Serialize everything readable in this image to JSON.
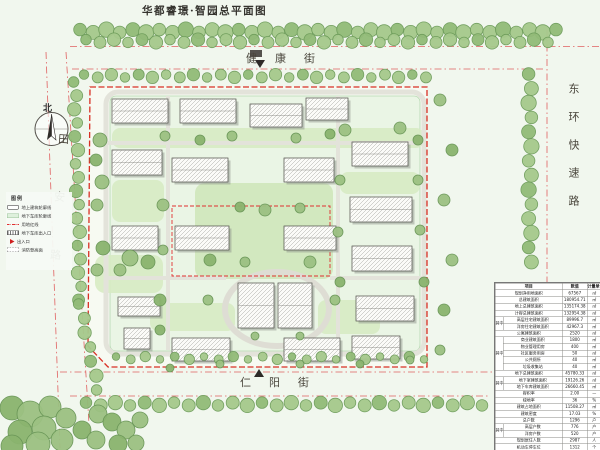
{
  "title": "华都睿璟·智园总平面图",
  "north": {
    "label": "北"
  },
  "streets": {
    "top": "健康街",
    "bottom": "仁阳街",
    "left": "田安路",
    "right": "东环快速路"
  },
  "legend": {
    "title": "图例",
    "items": [
      {
        "name": "building-outline",
        "swatch": "sw-building",
        "label": "地上建筑轮廓线"
      },
      {
        "name": "garage-outline",
        "swatch": "sw-garage",
        "label": "地下车库轮廓线"
      },
      {
        "name": "red-property-line",
        "swatch": "sw-redline",
        "label": "用地红线"
      },
      {
        "name": "garage-entrance",
        "swatch": "sw-gentry",
        "label": "地下车库出入口"
      },
      {
        "name": "site-entrance",
        "swatch": "sw-entry",
        "label": "出入口"
      },
      {
        "name": "fire-lane",
        "swatch": "sw-fire",
        "label": "消防登高面"
      }
    ]
  },
  "table": {
    "headers": [
      "项目",
      "数值",
      "计量单位"
    ],
    "group_label": "其中",
    "rows": [
      {
        "item": "规划净用地面积",
        "value": "67567",
        "unit": "㎡"
      },
      {
        "item": "总建筑面积",
        "value": "180954.71",
        "unit": "㎡"
      },
      {
        "item": "地上总建筑面积",
        "value": "135174.38",
        "unit": "㎡"
      },
      {
        "item": "计容总建筑面积",
        "value": "132954.38",
        "unit": "㎡"
      },
      {
        "g": 1,
        "item": "高层住宅建筑面积",
        "value": "89996.7",
        "unit": "㎡"
      },
      {
        "g": 1,
        "item": "洋房住宅建筑面积",
        "value": "42967.3",
        "unit": "㎡"
      },
      {
        "item": "公寓建筑面积",
        "value": "2520",
        "unit": "㎡"
      },
      {
        "g": 2,
        "item": "商业建筑面积",
        "value": "1800",
        "unit": "㎡"
      },
      {
        "g": 2,
        "item": "物业管理用房",
        "value": "400",
        "unit": "㎡"
      },
      {
        "g": 2,
        "item": "社区服务用房",
        "value": "50",
        "unit": "㎡"
      },
      {
        "g": 2,
        "item": "公共厕所",
        "value": "40",
        "unit": "㎡"
      },
      {
        "g": 2,
        "item": "垃圾收集站",
        "value": "40",
        "unit": "㎡"
      },
      {
        "item": "地下总建筑面积",
        "value": "45780.33",
        "unit": "㎡"
      },
      {
        "g": 3,
        "item": "地下室建筑面积",
        "value": "19126.26",
        "unit": "㎡"
      },
      {
        "g": 3,
        "item": "地下车库建筑面积",
        "value": "26660.45",
        "unit": "㎡"
      },
      {
        "item": "容积率",
        "value": "2.00",
        "unit": "—"
      },
      {
        "item": "绿地率",
        "value": "36",
        "unit": "%"
      },
      {
        "item": "建筑占地面积",
        "value": "11508.27",
        "unit": "㎡"
      },
      {
        "item": "建筑密度",
        "value": "17.03",
        "unit": "%"
      },
      {
        "item": "总户数",
        "value": "1296",
        "unit": "户"
      },
      {
        "g": 4,
        "item": "高层户数",
        "value": "776",
        "unit": "户"
      },
      {
        "g": 4,
        "item": "洋房户数",
        "value": "520",
        "unit": "户"
      },
      {
        "item": "规划居住人数",
        "value": "2987",
        "unit": "人"
      },
      {
        "item": "机动车停车位",
        "value": "1312",
        "unit": "个"
      },
      {
        "item": "非机动车停车位",
        "value": "2366",
        "unit": "辆"
      }
    ]
  }
}
